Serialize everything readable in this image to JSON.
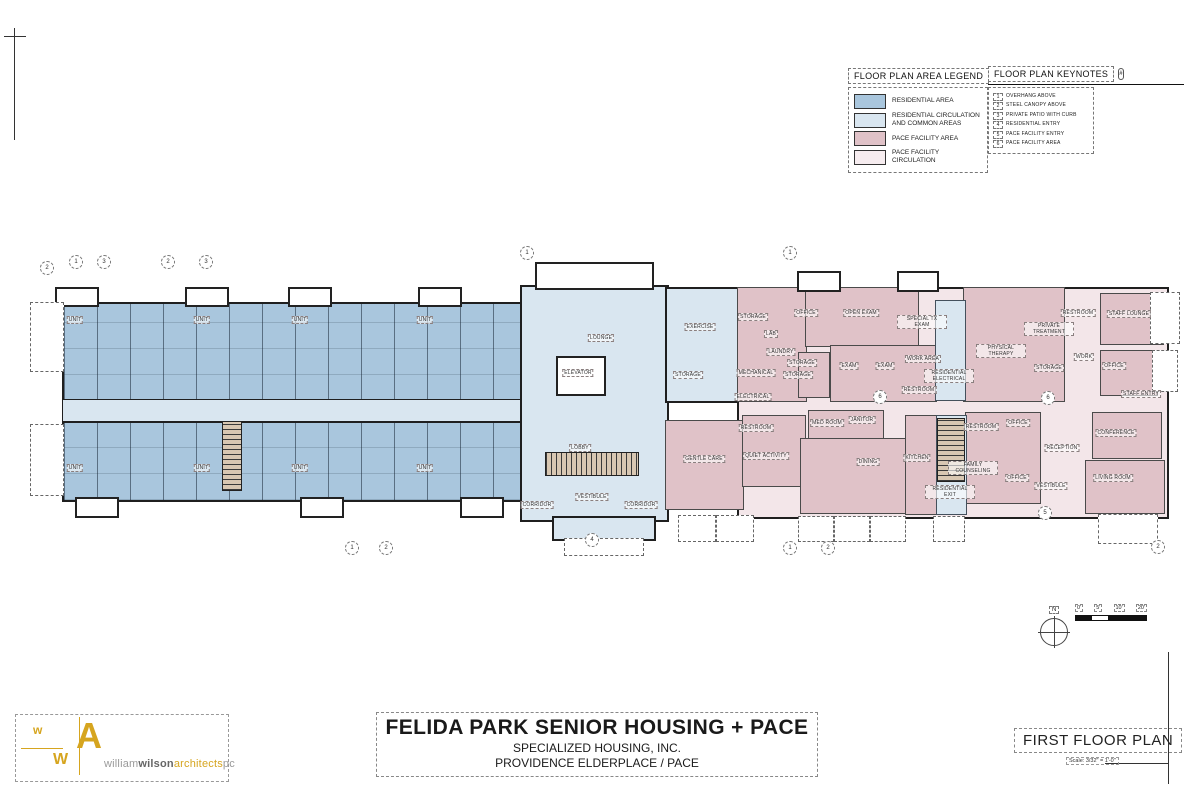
{
  "legend": {
    "title": "FLOOR PLAN AREA LEGEND",
    "items": [
      {
        "label": "RESIDENTIAL AREA",
        "color": "#a9c6dd"
      },
      {
        "label": "RESIDENTIAL CIRCULATION AND COMMON AREAS",
        "color": "#d9e6f0"
      },
      {
        "label": "PACE FACILITY AREA",
        "color": "#e0c2c8"
      },
      {
        "label": "PACE FACILITY CIRCULATION",
        "color": "#f6ecef"
      }
    ]
  },
  "keynotes": {
    "title": "FLOOR PLAN KEYNOTES",
    "symbol": "#",
    "items": [
      "OVERHANG ABOVE",
      "STEEL CANOPY ABOVE",
      "PRIVATE PATIO WITH CURB",
      "RESIDENTIAL ENTRY",
      "PACE FACILITY ENTRY",
      "PACE FACILITY AREA"
    ]
  },
  "plan": {
    "rooms": [
      {
        "name": "LOUNGE",
        "x": 601,
        "y": 338
      },
      {
        "name": "ELEVATOR",
        "x": 578,
        "y": 373
      },
      {
        "name": "LOBBY",
        "x": 580,
        "y": 448
      },
      {
        "name": "VESTIBULE",
        "x": 592,
        "y": 497
      },
      {
        "name": "CORRIDOR",
        "x": 537,
        "y": 505
      },
      {
        "name": "CORRIDOR",
        "x": 641,
        "y": 505
      },
      {
        "name": "EXERCISE",
        "x": 700,
        "y": 327
      },
      {
        "name": "STORAGE",
        "x": 688,
        "y": 375
      },
      {
        "name": "RESIDENTIAL ELECTRICAL",
        "x": 949,
        "y": 376
      },
      {
        "name": "RESIDENTIAL EXIT",
        "x": 950,
        "y": 492
      },
      {
        "name": "STORAGE",
        "x": 753,
        "y": 317
      },
      {
        "name": "LAB",
        "x": 771,
        "y": 334
      },
      {
        "name": "OFFICE",
        "x": 806,
        "y": 313
      },
      {
        "name": "OPEN EXAM",
        "x": 861,
        "y": 313
      },
      {
        "name": "SPECIAL TX EXAM",
        "x": 922,
        "y": 322
      },
      {
        "name": "LAUNDRY",
        "x": 781,
        "y": 352
      },
      {
        "name": "STORAGE",
        "x": 802,
        "y": 363
      },
      {
        "name": "STORAGE",
        "x": 798,
        "y": 375
      },
      {
        "name": "MECHANICAL",
        "x": 756,
        "y": 373
      },
      {
        "name": "ELECTRICAL",
        "x": 753,
        "y": 397
      },
      {
        "name": "EXAM",
        "x": 849,
        "y": 366
      },
      {
        "name": "EXAM",
        "x": 885,
        "y": 366
      },
      {
        "name": "WORK AREA",
        "x": 923,
        "y": 359
      },
      {
        "name": "RESTROOM",
        "x": 919,
        "y": 390
      },
      {
        "name": "PHYSICAL THERAPY",
        "x": 1001,
        "y": 351
      },
      {
        "name": "PRIVATE TREATMENT",
        "x": 1049,
        "y": 329
      },
      {
        "name": "RESTROOM",
        "x": 1078,
        "y": 313
      },
      {
        "name": "STAFF LOUNGE",
        "x": 1129,
        "y": 314
      },
      {
        "name": "WORK",
        "x": 1084,
        "y": 357
      },
      {
        "name": "STORAGE",
        "x": 1049,
        "y": 368
      },
      {
        "name": "OFFICE",
        "x": 1114,
        "y": 366
      },
      {
        "name": "STAFF ENTRY",
        "x": 1141,
        "y": 394
      },
      {
        "name": "RESTROOM",
        "x": 756,
        "y": 428
      },
      {
        "name": "QUIET ACTIVITY",
        "x": 766,
        "y": 456
      },
      {
        "name": "GENTLE CARE",
        "x": 704,
        "y": 459
      },
      {
        "name": "MED ROOM",
        "x": 827,
        "y": 423
      },
      {
        "name": "JANITOR",
        "x": 862,
        "y": 420
      },
      {
        "name": "DINING",
        "x": 868,
        "y": 462
      },
      {
        "name": "KITCHEN",
        "x": 917,
        "y": 458
      },
      {
        "name": "RESTROOM",
        "x": 981,
        "y": 427
      },
      {
        "name": "OFFICE",
        "x": 1018,
        "y": 423
      },
      {
        "name": "FAMILY COUNSELING",
        "x": 973,
        "y": 468
      },
      {
        "name": "OFFICE",
        "x": 1017,
        "y": 478
      },
      {
        "name": "RECEPTION",
        "x": 1062,
        "y": 448
      },
      {
        "name": "VESTIBULE",
        "x": 1051,
        "y": 486
      },
      {
        "name": "CONFERENCE",
        "x": 1116,
        "y": 433
      },
      {
        "name": "LIVING ROOM",
        "x": 1113,
        "y": 478
      },
      {
        "name": "UNIT",
        "x": 75,
        "y": 320
      },
      {
        "name": "UNIT",
        "x": 202,
        "y": 320
      },
      {
        "name": "UNIT",
        "x": 300,
        "y": 320
      },
      {
        "name": "UNIT",
        "x": 425,
        "y": 320
      },
      {
        "name": "UNIT",
        "x": 75,
        "y": 468
      },
      {
        "name": "UNIT",
        "x": 202,
        "y": 468
      },
      {
        "name": "UNIT",
        "x": 300,
        "y": 468
      },
      {
        "name": "UNIT",
        "x": 425,
        "y": 468
      }
    ],
    "markers": [
      {
        "n": "2",
        "x": 47,
        "y": 268
      },
      {
        "n": "1",
        "x": 76,
        "y": 262
      },
      {
        "n": "3",
        "x": 104,
        "y": 262
      },
      {
        "n": "2",
        "x": 168,
        "y": 262
      },
      {
        "n": "3",
        "x": 206,
        "y": 262
      },
      {
        "n": "1",
        "x": 527,
        "y": 253
      },
      {
        "n": "1",
        "x": 790,
        "y": 253
      },
      {
        "n": "1",
        "x": 352,
        "y": 548
      },
      {
        "n": "2",
        "x": 386,
        "y": 548
      },
      {
        "n": "4",
        "x": 592,
        "y": 540
      },
      {
        "n": "1",
        "x": 790,
        "y": 548
      },
      {
        "n": "2",
        "x": 828,
        "y": 548
      },
      {
        "n": "5",
        "x": 1045,
        "y": 513
      },
      {
        "n": "2",
        "x": 1158,
        "y": 547
      },
      {
        "n": "6",
        "x": 880,
        "y": 397
      },
      {
        "n": "6",
        "x": 1048,
        "y": 398
      }
    ]
  },
  "north": "N",
  "scalebar": [
    "0'",
    "5'",
    "10'",
    "20'"
  ],
  "titleblock": {
    "project": "FELIDA PARK SENIOR HOUSING + PACE",
    "line2": "SPECIALIZED HOUSING, INC.",
    "line3": "PROVIDENCE ELDERPLACE / PACE"
  },
  "sheet": {
    "name": "FIRST FLOOR PLAN",
    "scale": "Scale: 3/32\" = 1'-0\""
  },
  "logo": {
    "m1": "w",
    "m2": "A",
    "m3": "W",
    "w1": "william",
    "w2": "wilson",
    "w3": "architects",
    "w4": "pc"
  }
}
